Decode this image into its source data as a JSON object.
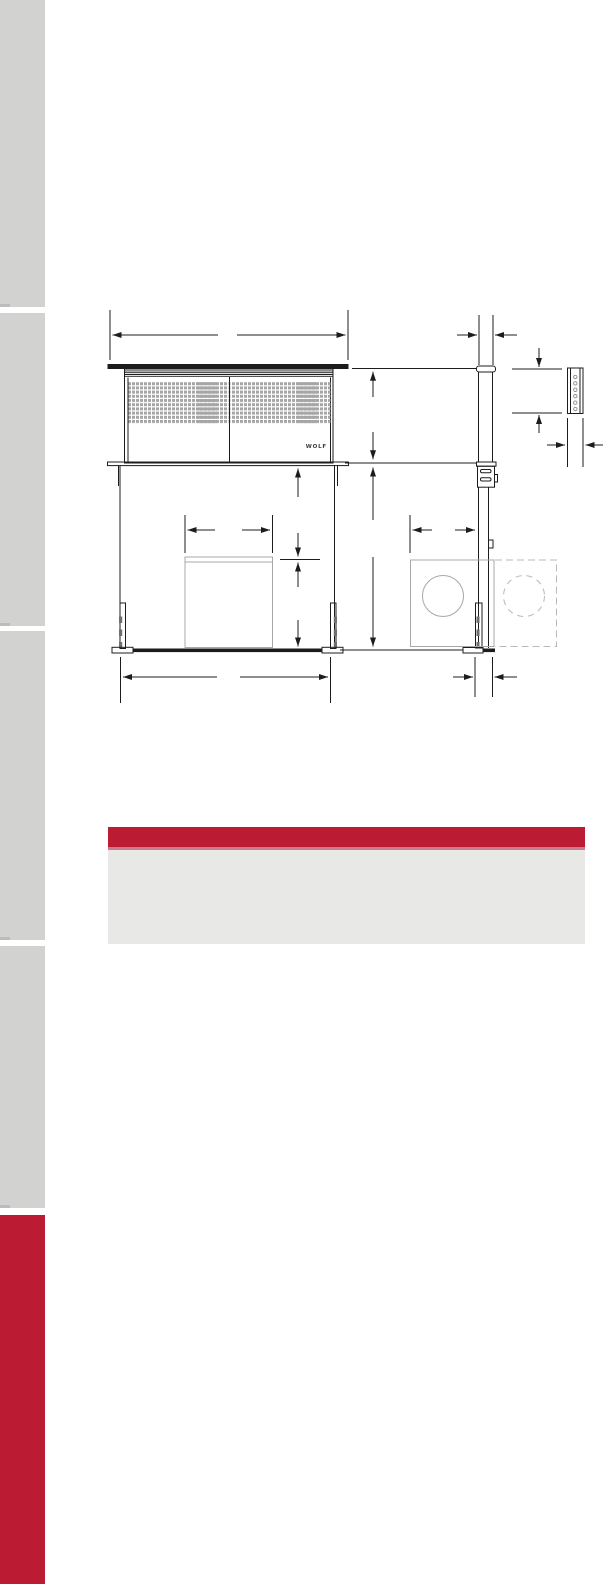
{
  "page": {
    "type": "specification-document-page",
    "background_color": "#ffffff"
  },
  "sidebar": {
    "segment_color": "#d2d2d1",
    "active_segment_color": "#bb1c34",
    "segments": [
      {
        "id": "section-1",
        "state": "inactive"
      },
      {
        "id": "section-2",
        "state": "inactive"
      },
      {
        "id": "section-3",
        "state": "inactive"
      },
      {
        "id": "section-4",
        "state": "inactive"
      },
      {
        "id": "section-5",
        "state": "active"
      }
    ]
  },
  "drawing": {
    "wolf_logo": "WOLF",
    "line_color": "#1c1c1c",
    "grille_fill_color": "#a6a6a6",
    "accessory_line_color": "#a8a8a8",
    "dashed_line_color": "#b8b8b8",
    "views": [
      "front-elevation",
      "side-elevation",
      "mounting-bracket-detail"
    ]
  },
  "callout": {
    "bar_color": "#bb1c34",
    "underline_color": "#cb7b8b",
    "panel_color": "#e8e8e7"
  }
}
